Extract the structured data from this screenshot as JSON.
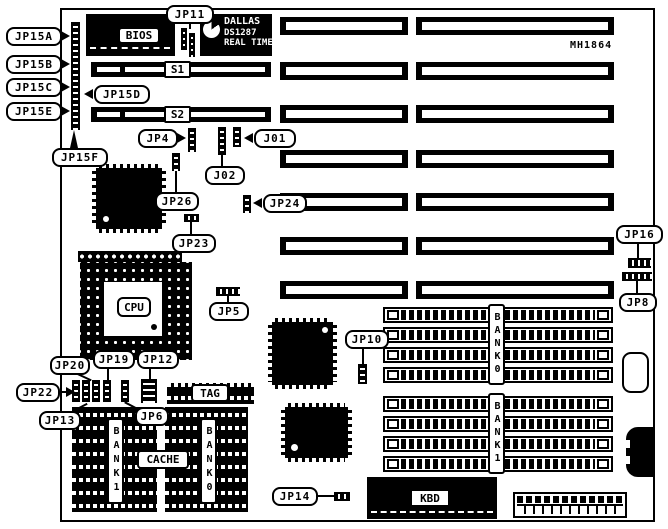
{
  "board": {
    "model": "MH1864"
  },
  "chips": {
    "bios": "BIOS",
    "rtc_brand": "DALLAS",
    "rtc_part": "DS1287",
    "rtc_line": "REAL TIME",
    "cpu": "CPU",
    "kbd": "KBD",
    "tag": "TAG",
    "cache": "CACHE"
  },
  "memory": {
    "cache_bank1": "BANK1",
    "cache_bank0": "BANK0",
    "simm_bank0": "BANK0",
    "simm_bank1": "BANK1"
  },
  "slots": {
    "s1": "S1",
    "s2": "S2"
  },
  "jumpers": {
    "jp15a": "JP15A",
    "jp15b": "JP15B",
    "jp15c": "JP15C",
    "jp15d": "JP15D",
    "jp15e": "JP15E",
    "jp15f": "JP15F",
    "jp11": "JP11",
    "jp4": "JP4",
    "j01": "J01",
    "j02": "J02",
    "jp26": "JP26",
    "jp24": "JP24",
    "jp23": "JP23",
    "jp16": "JP16",
    "jp8": "JP8",
    "jp5": "JP5",
    "jp10": "JP10",
    "jp20": "JP20",
    "jp19": "JP19",
    "jp12": "JP12",
    "jp22": "JP22",
    "jp13": "JP13",
    "jp6": "JP6",
    "jp14": "JP14"
  },
  "colors": {
    "ink": "#000000",
    "paper": "#ffffff"
  }
}
